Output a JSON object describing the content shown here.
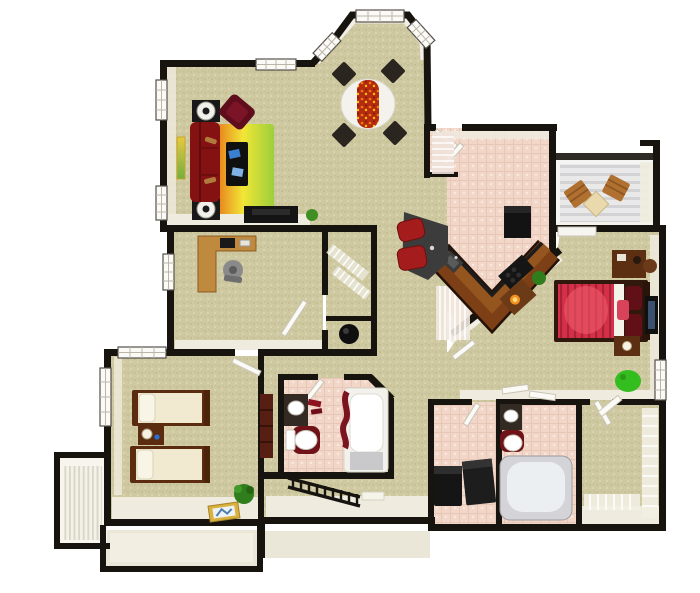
{
  "scene": {
    "type": "3d-apartment-floor-plan-top-view",
    "rooms": [
      {
        "name": "living-room",
        "floor": "carpet"
      },
      {
        "name": "dining-nook-bay-window",
        "floor": "carpet"
      },
      {
        "name": "kitchen",
        "floor": "pink-tile"
      },
      {
        "name": "entry-foyer",
        "floor": "pink-tile"
      },
      {
        "name": "pantry-closet",
        "floor": "pink-tile"
      },
      {
        "name": "screened-balcony",
        "floor": "wood-deck"
      },
      {
        "name": "master-bedroom",
        "floor": "carpet"
      },
      {
        "name": "master-bathroom",
        "floor": "pink-tile"
      },
      {
        "name": "walk-in-closet",
        "floor": "carpet"
      },
      {
        "name": "laundry-room",
        "floor": "pink-tile"
      },
      {
        "name": "hall-bathroom",
        "floor": "pink-tile"
      },
      {
        "name": "office-bedroom",
        "floor": "carpet"
      },
      {
        "name": "twin-bedroom",
        "floor": "carpet"
      },
      {
        "name": "hall-closet",
        "floor": "carpet"
      },
      {
        "name": "water-heater-closet",
        "floor": "carpet"
      },
      {
        "name": "linen-closet",
        "floor": "carpet"
      },
      {
        "name": "hallway",
        "floor": "carpet"
      },
      {
        "name": "entry-stairwell",
        "floor": "stairs"
      },
      {
        "name": "lower-porch-left",
        "floor": "cream"
      },
      {
        "name": "lower-porch-center",
        "floor": "cream"
      }
    ],
    "furniture": [
      "red-sofa",
      "maroon-armchair",
      "gradient-area-rug",
      "coffee-table",
      "round-end-tables",
      "tv-console",
      "wall-art",
      "round-dining-table-with-runner",
      "dining-chairs",
      "l-shaped-desk",
      "office-chair",
      "computer-monitor",
      "v-shaped-kitchen-counter",
      "refrigerator",
      "range",
      "kitchen-sink",
      "breakfast-bar",
      "red-bar-stools",
      "console-table-with-lamp",
      "potted-plants",
      "balcony-wood-chairs",
      "balcony-table",
      "master-bed-red",
      "bedroom-desk",
      "wall-mounted-tv",
      "nightstand",
      "green-bean-bag",
      "garden-tub",
      "bathroom-vanities",
      "toilets",
      "tub-with-maroon-shower-curtain",
      "washer",
      "dryer",
      "wire-closet-shelving",
      "twin-beds",
      "twin-nightstand-with-lamp",
      "tall-dresser",
      "floor-picture-frame",
      "stair-railing",
      "stair-treads",
      "water-heater"
    ]
  },
  "palette": {
    "background": "#ffffff",
    "wall": "#17130e",
    "wall_face": "#efecdf",
    "screen_dark": "#2e2a26",
    "carpet_base": "#cfc9a2",
    "carpet_dot_dark": "#c2bc92",
    "carpet_dot_light": "#dcd7b3",
    "tile_base": "#f2d7c9",
    "tile_speck": "#fae8de",
    "tile_line": "#e7c8b8",
    "deck_base": "#e9e9e9",
    "deck_stripe": "#d3d3d5",
    "porch": "#eae7d8",
    "stair_room": "#f7f5ee",
    "counter_wood": "#7c3f16",
    "counter_wood_light": "#95551f",
    "cabinet_wood": "#6b3a16",
    "desk_wood": "#c08a3e",
    "sofa_red": "#851212",
    "armchair_maroon": "#5f0d1d",
    "rug_orange": "#e8821e",
    "rug_yellow": "#f2e636",
    "rug_green": "#9ccf3a",
    "runner_red": "#b62a0e",
    "bed_red": "#d63048",
    "bed_stripe": "#a82238",
    "pillow_maroon": "#611018",
    "twin_bedding": "#f1ead0",
    "bed_frame_brown": "#5c2c10",
    "appliance_black": "#161616",
    "stool_red": "#a51c1c",
    "bar_dark": "#3c3c3c",
    "tub_gray": "#d4d4d8",
    "porcelain": "#ffffff",
    "curtain_maroon": "#7c1420",
    "plant_green": "#2f7d1c",
    "beanbag_green": "#33bd1f",
    "chair_wood": "#b07030",
    "balcony_table_cream": "#ead9ac"
  }
}
